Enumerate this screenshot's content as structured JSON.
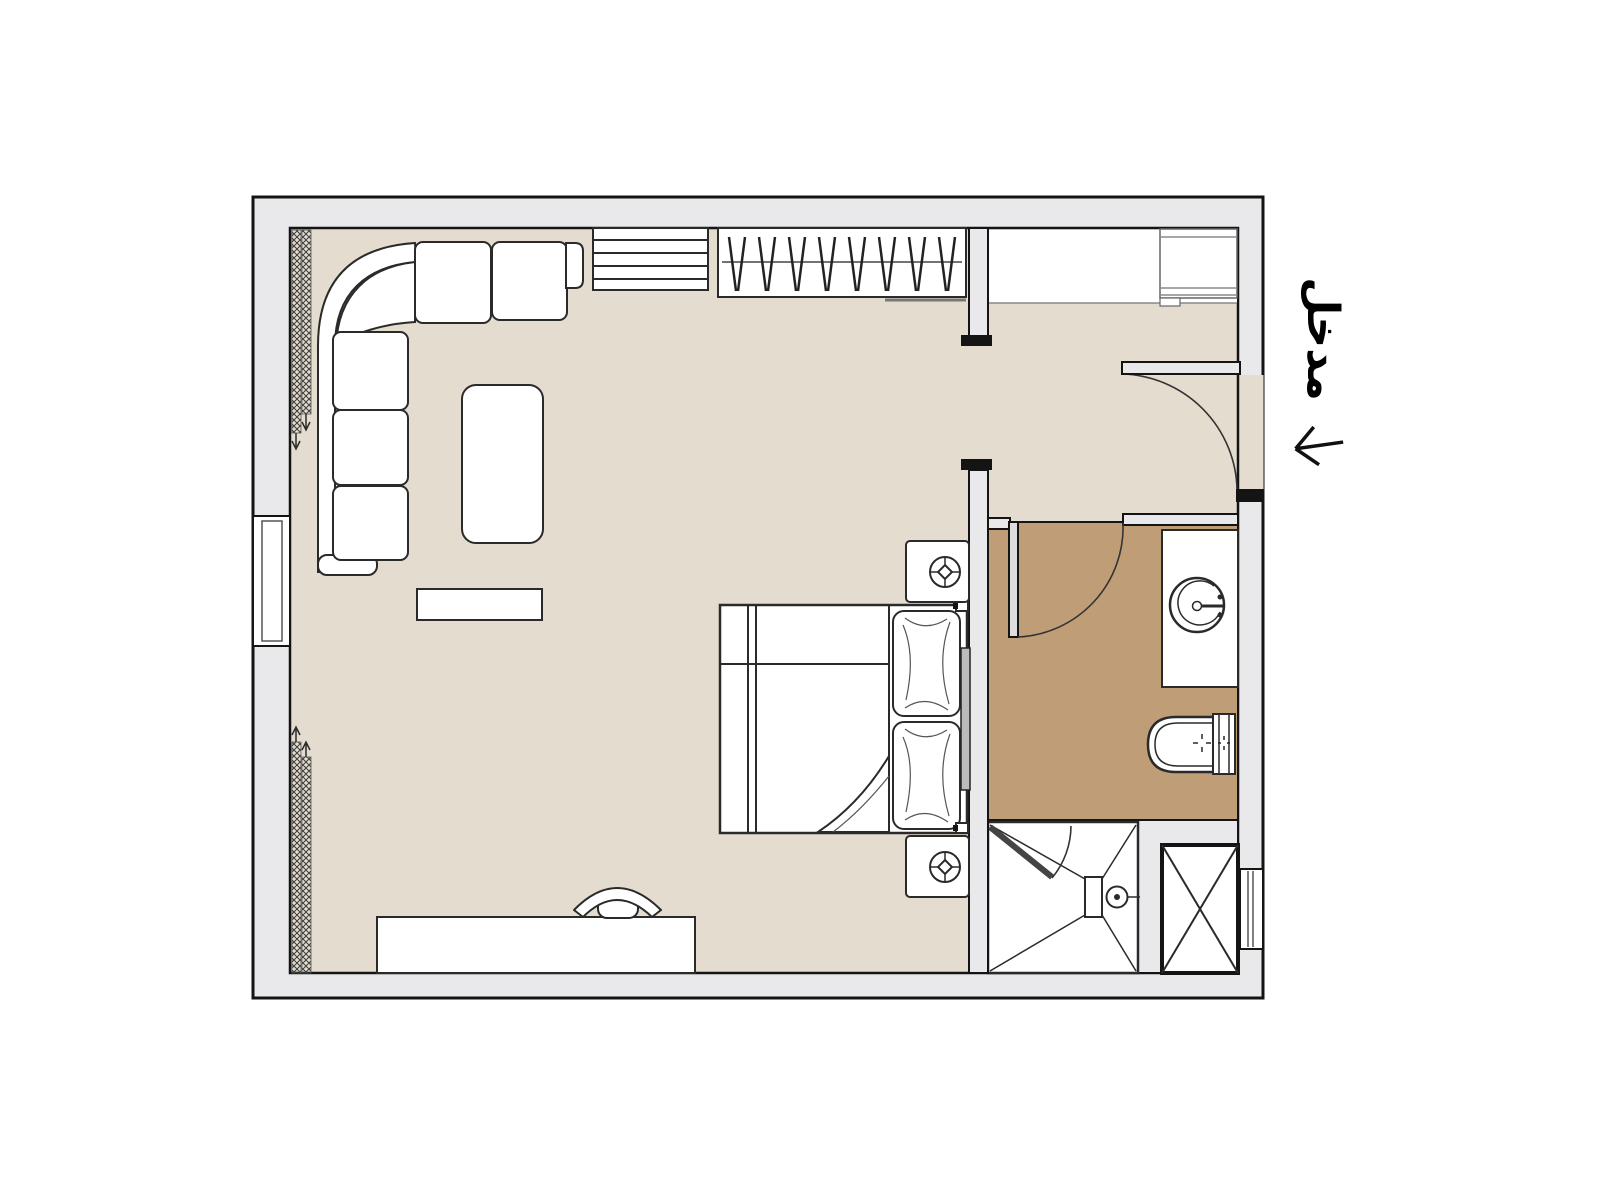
{
  "labels": {
    "entrance": "مدخل"
  },
  "colors": {
    "background": "#ffffff",
    "wall_fill": "#e9e8ea",
    "outline": "#141414",
    "floor_main": "#e4ddcf",
    "floor_bathroom": "#bf9d76",
    "furniture_fill": "#ffffff",
    "furniture_stroke": "#2a2a2a",
    "thin_gray": "#8a8a8a",
    "door_fill": "#dddddd",
    "label_color": "#000000"
  },
  "plan": {
    "type": "apartment-floor-plan",
    "rooms": [
      "main-living-sleeping-area",
      "bathroom",
      "entry-vestibule",
      "entry-closet"
    ],
    "symbols": [
      "l-shaped-sofa",
      "coffee-table",
      "media-console",
      "shelf-unit",
      "closet-with-hangers",
      "closet-rod",
      "entry-cabinet",
      "double-bed",
      "pillow",
      "pillow",
      "headboard",
      "nightstand-with-lamp",
      "nightstand-with-lamp",
      "desk",
      "desk-chair",
      "curtain-coil",
      "curtain-coil",
      "window",
      "window",
      "entrance-door",
      "bathroom-door",
      "shower-door",
      "vanity-with-sink",
      "toilet",
      "shower-tray-with-drain",
      "service-shaft",
      "entrance-arrow"
    ]
  }
}
